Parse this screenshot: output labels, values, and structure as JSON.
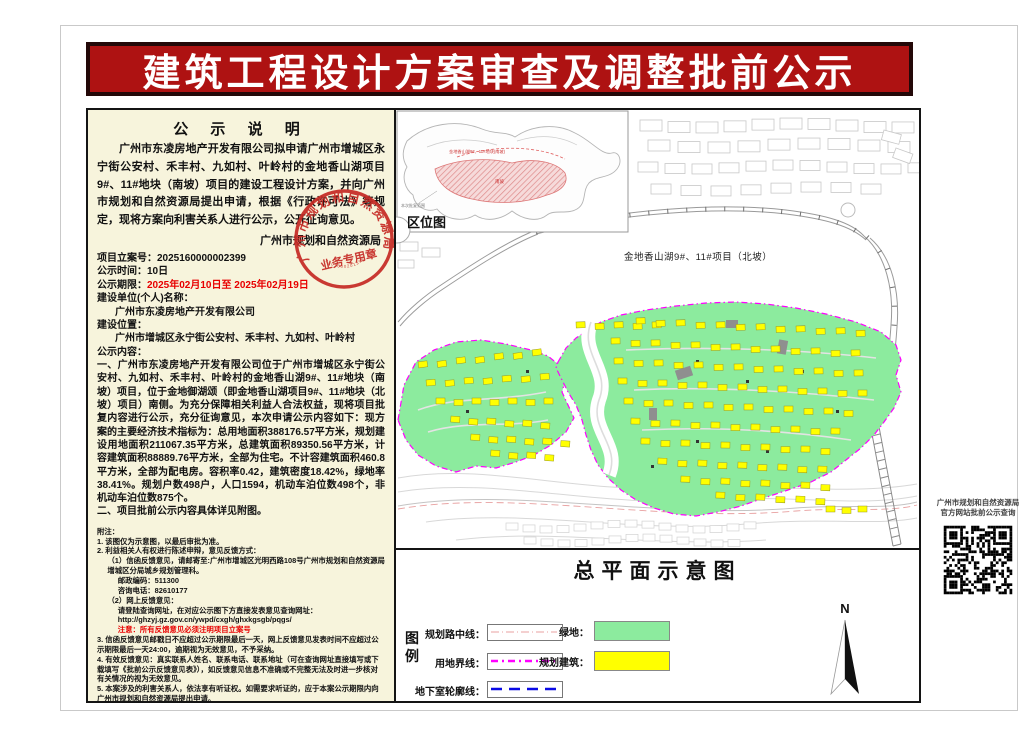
{
  "colors": {
    "banner_red": "#AE1212",
    "panel_beige": "#F7F4DC",
    "greenery": "#8CEB9E",
    "planned_building_yellow": "#FFFF00",
    "site_boundary_magenta": "#FF00FF",
    "basement_line_blue": "#0A0AE6",
    "seal_red": "#C62B26",
    "alert_red": "#E80000",
    "road_center_pink": "#E8A0A0"
  },
  "banner": {
    "title": "建筑工程设计方案审查及调整批前公示"
  },
  "notice": {
    "heading": "公  示  说  明",
    "body": "广州市东凌房地产开发有限公司拟申请广州市增城区永宁街公安村、禾丰村、九如村、叶岭村的金地香山湖项目9#、11#地块（南坡）项目的建设工程设计方案，并向广州市规划和自然资源局提出申请，根据《行政许可法》等规定，现将方案向利害关系人进行公示，公开征询意见。",
    "signature": "广州市规划和自然资源局",
    "seal": {
      "org": "广州市规划和自然资源局",
      "type": "业务专用章"
    },
    "info": {
      "case_label": "项目立案号：",
      "case_no": "2025160000002399",
      "duration_label": "公示时间：",
      "duration": "10日",
      "period_label": "公示期限：",
      "period": "2025年02月10日至  2025年02月19日",
      "applicant_label": "建设单位(个人)名称：",
      "applicant": "广州市东凌房地产开发有限公司",
      "location_label": "建设位置：",
      "location": "广州市增城区永宁街公安村、禾丰村、九如村、叶岭村",
      "content_label": "公示内容："
    },
    "content": {
      "para1": "一、广州市东凌房地产开发有限公司位于广州市增城区永宁街公安村、九如村、禾丰村、叶岭村的金地香山湖9#、11#地块（南坡）项目，位于金地御湖颂（即金地香山湖项目9#、11#地块（北坡）项目）南侧。为充分保障相关利益人合法权益，现将项目批复内容进行公示，充分征询意见，本次申请公示内容如下：现方案的主要经济技术指标为：总用地面积388176.57平方米，规划建设用地面积211067.35平方米，总建筑面积89350.56平方米，计容建筑面积88889.76平方米，全部为住宅。不计容建筑面积460.8平方米，全部为配电房。容积率0.42，建筑密度18.42%，绿地率38.41%。规划户数498户，人口1594，机动车泊位数498个，非机动车泊位数875个。",
      "para2": "二、项目批前公示内容具体详见附图。"
    },
    "notes": {
      "title": "附注：",
      "n1": "1. 该图仅为示意图，以最后审批为准。",
      "n2": "2. 利益相关人有权进行陈述申辩，意见反馈方式：",
      "n2_1": "（1）信函反馈意见，请邮寄至:广州市增城区光明西路108号广州市规划和自然资源局增城区分局城乡规划管理科。",
      "n2_1a": "邮政编码：511300",
      "n2_1b": "咨询电话：82610177",
      "n2_2": "（2）网上反馈意见：",
      "n2_2a": "请登陆查询网址，在对应公示图下方直接发表意见查询网址：",
      "n2_2b": "http://ghzyj.gz.gov.cn/ywpd/cxgh/ghxkgsgb/pqgs/",
      "n2_2c": "注意：所有反馈意见必须注明项目立案号",
      "n3": "3. 信函反馈意见邮戳日不应超过公示期限最后一天，网上反馈意见发表时间不应超过公示期限最后一天24:00，逾期视为无效意见，不予采纳。",
      "n4": "4. 有效反馈意见：真实联系人姓名、联系电话、联系地址（可在查询网址直接填写或下载填写《批前公示反馈意见表》），如反馈意见信息不准确或不完整无法及时进一步核对有关情况的视为无效意见。",
      "n5": "5. 本案涉及的利害关系人，依法享有听证权。如需要求听证的，应于本案公示期限内向广州市规划和自然资源局提出申请。"
    }
  },
  "map": {
    "inset_label": "区位图",
    "inset_site_text": "金地香山湖9#、11#地块(南坡)",
    "inset_area_text": "南坡",
    "inset_note": "本次批复范围",
    "north_site_label": "金地香山湖9#、11#项目（北坡）",
    "plan_title": "总平面示意图",
    "north_label": "N",
    "legend": {
      "group_label": "图例",
      "line_items": [
        {
          "label": "规划路中线："
        },
        {
          "label": "用地界线："
        },
        {
          "label": "地下室轮廓线："
        }
      ],
      "fill_items": [
        {
          "label": "绿地："
        },
        {
          "label": "规划建筑："
        }
      ]
    }
  },
  "qr": {
    "caption1": "广州市规划和自然资源局",
    "caption2": "官方网站批前公示查询"
  }
}
